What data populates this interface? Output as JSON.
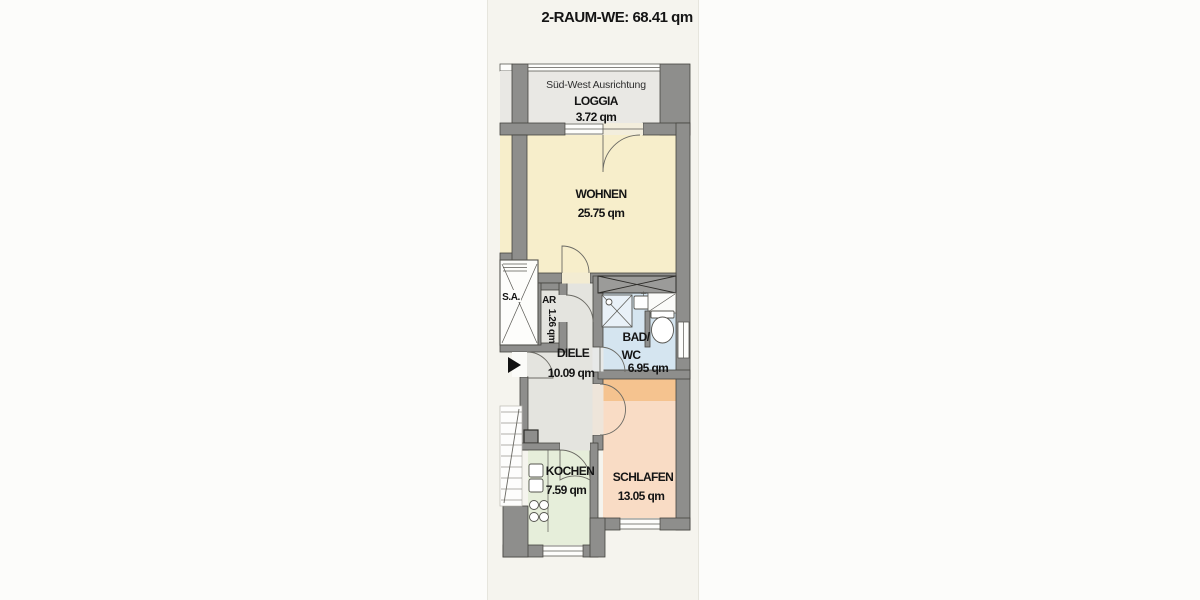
{
  "title": "2-RAUM-WE: 68.41 qm",
  "rooms": {
    "loggia": {
      "orientation": "Süd-West Ausrichtung",
      "name": "LOGGIA",
      "area": "3.72 qm"
    },
    "wohnen": {
      "name": "WOHNEN",
      "area": "25.75 qm"
    },
    "diele": {
      "name": "DIELE",
      "area": "10.09 qm"
    },
    "ar": {
      "name": "AR",
      "area": "1.26 qm"
    },
    "bad": {
      "name_line1": "BAD/",
      "name_line2": "WC",
      "area": "6.95 qm"
    },
    "schlafen": {
      "name": "SCHLAFEN",
      "area": "13.05 qm"
    },
    "kochen": {
      "name": "KOCHEN",
      "area": "7.59 qm"
    },
    "elevator": {
      "label": "S.A."
    }
  },
  "colors": {
    "paper": "#f5f4ee",
    "wall": "#8e8e8c",
    "shaft": "#9b9b99",
    "loggia": "#e9e8e4",
    "wohnen": "#f7eecb",
    "diele": "#e4e4df",
    "ar": "#e4e4df",
    "bad": "#d5e5f0",
    "schlafen": "#f9dcc5",
    "schlafen_band": "#f5c38f",
    "kochen": "#e6eeda",
    "entrance_arrow": "#111111"
  }
}
